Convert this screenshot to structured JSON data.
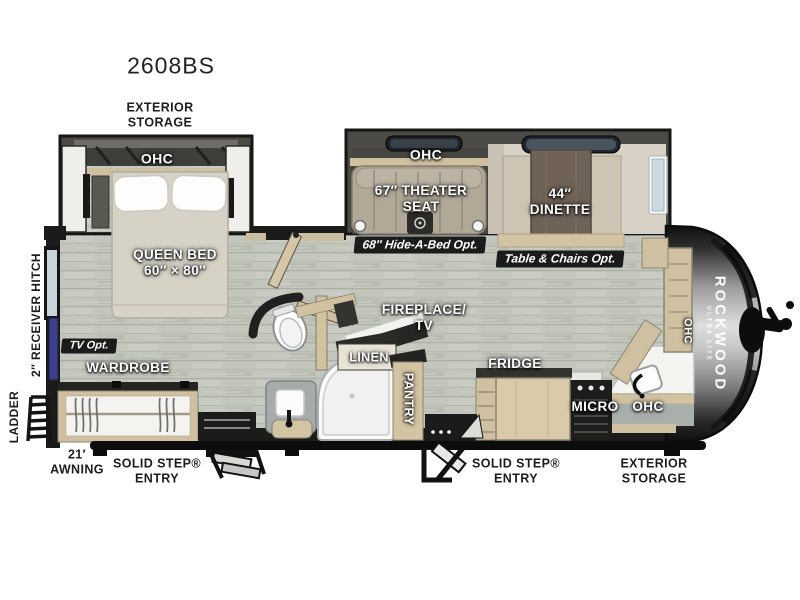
{
  "model": "2608BS",
  "colors": {
    "floor_wood": "#c3c6bc",
    "cabinet_tan": "#d2c3a2",
    "wall_dark": "#1b1b1a",
    "tv_accent_blue": "#3d3f8e",
    "badge_bg": "#1b1b1b",
    "label_white": "#ffffff"
  },
  "labels": {
    "exterior_storage_top": "EXTERIOR\nSTORAGE",
    "bedroom_ohc": "OHC",
    "queen_bed": "QUEEN BED\n60″ × 80″",
    "tv_opt": "TV Opt.",
    "wardrobe": "WARDROBE",
    "receiver_hitch": "2″ RECEIVER HITCH",
    "ladder": "LADDER",
    "awning": "21′\nAWNING",
    "entry_rear": "SOLID STEP®\nENTRY",
    "living_ohc": "OHC",
    "theater_seat": "67″ THEATER\nSEAT",
    "dinette": "44″\nDINETTE",
    "hide_a_bed_opt": "68″ Hide-A-Bed Opt.",
    "table_chairs_opt": "Table & Chairs Opt.",
    "fireplace_tv": "FIREPLACE/\nTV",
    "linen": "LINEN",
    "pantry": "PANTRY",
    "fridge": "FRIDGE",
    "micro": "MICRO",
    "kitchen_ohc": "OHC",
    "wall_ohc": "OHC",
    "entry_front": "SOLID STEP®\nENTRY",
    "exterior_storage_bottom": "EXTERIOR\nSTORAGE",
    "brand": "ROCKWOOD",
    "brand_sub": "ULTRA LITE"
  }
}
